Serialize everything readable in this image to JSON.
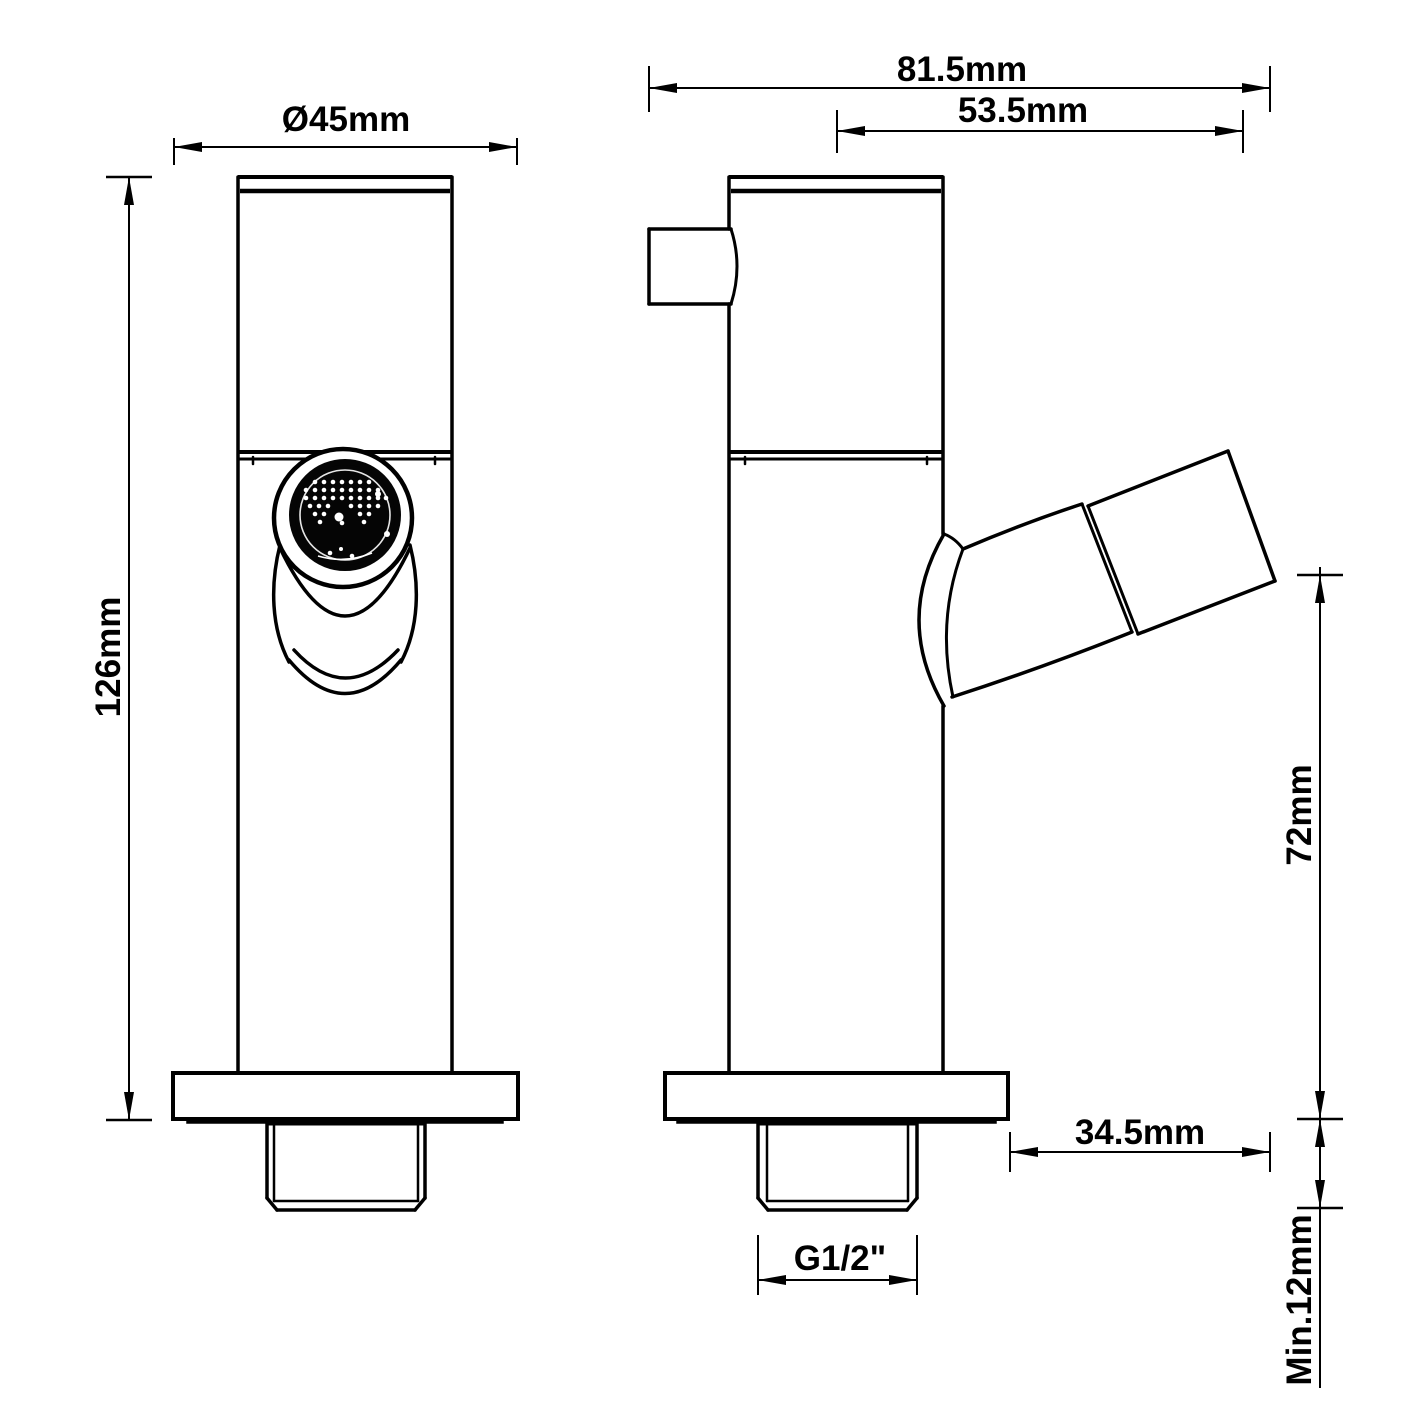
{
  "drawing": {
    "type": "technical-dimension-drawing",
    "subject": "bidet tap / faucet two-view drawing",
    "background_color": "#ffffff",
    "line_color": "#000000",
    "views": {
      "front_view": "front elevation",
      "side_view": "side elevation"
    },
    "dimensions": {
      "flange_diameter": "Ø45mm",
      "overall_depth": "81.5mm",
      "spout_offset": "53.5mm",
      "overall_height": "126mm",
      "outlet_height": "72mm",
      "spout_reach": "34.5mm",
      "inlet_thread": "G1/2\"",
      "min_mount_thickness": "Min.12mm"
    }
  }
}
